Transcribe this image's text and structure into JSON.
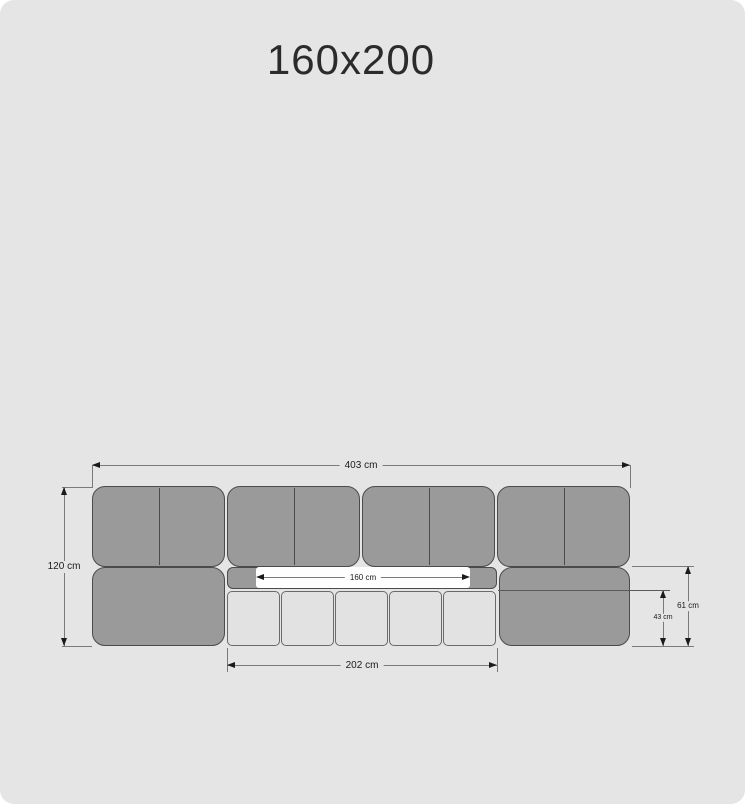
{
  "title": "160x200",
  "labels": {
    "total_width": "403 cm",
    "total_height": "120 cm",
    "mattress_width": "160 cm",
    "cushion_row_width": "202 cm",
    "base_height": "61 cm",
    "cushion_height": "43 cm"
  },
  "colors": {
    "bg": "#e5e5e5",
    "panel_fill": "#9a9a9a",
    "panel_stroke": "#4b4b4b",
    "cushion_fill": "#e2e2e2",
    "cushion_stroke": "#6a6a6a",
    "mattress_fill": "#fefefe",
    "dim_line": "#7a7a7a",
    "dim_ink": "#1a1a1a",
    "title_ink": "#2b2b2b"
  }
}
